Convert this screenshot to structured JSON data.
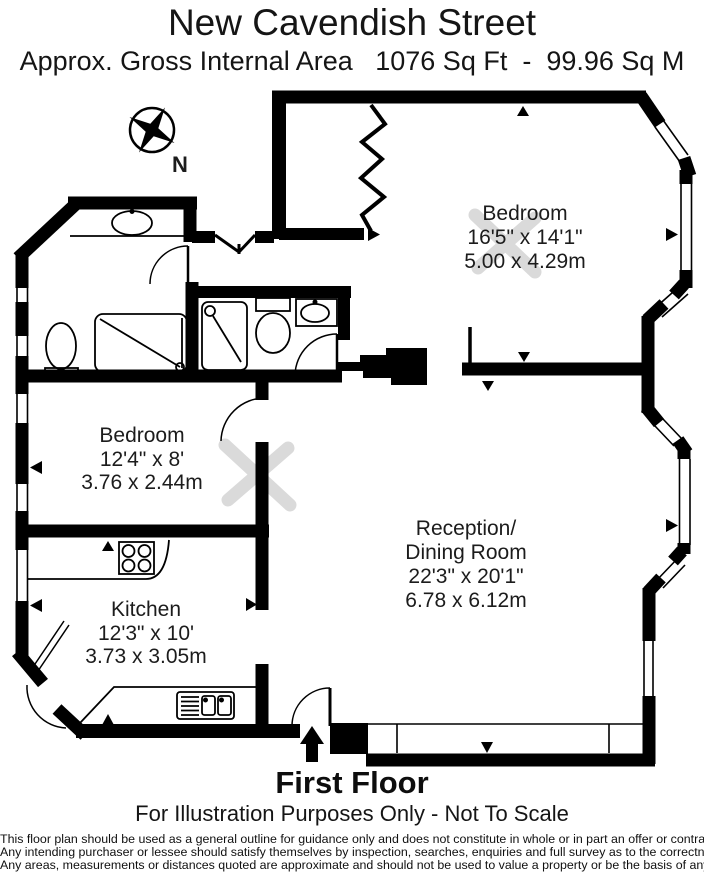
{
  "header": {
    "title": "New Cavendish Street",
    "area_line": "Approx. Gross Internal Area   1076 Sq Ft  -  99.96 Sq M"
  },
  "compass": {
    "north_label": "N"
  },
  "rooms": {
    "bedroom_main": {
      "name": "Bedroom",
      "imperial": "16'5\" x 14'1\"",
      "metric": "5.00 x 4.29m"
    },
    "bedroom_second": {
      "name": "Bedroom",
      "imperial": "12'4\" x 8'",
      "metric": "3.76 x 2.44m"
    },
    "kitchen": {
      "name": "Kitchen",
      "imperial": "12'3\" x 10'",
      "metric": "3.73 x 3.05m"
    },
    "reception": {
      "name_line1": "Reception/",
      "name_line2": "Dining Room",
      "imperial": "22'3\" x 20'1\"",
      "metric": "6.78 x 6.12m"
    }
  },
  "footer": {
    "floor_label": "First Floor",
    "scale_note": "For Illustration Purposes Only - Not To Scale",
    "disclaimer": [
      "This floor plan should be used as a general outline for guidance only and does not constitute in whole or in part an offer or contract.",
      "Any intending purchaser or lessee should satisfy themselves by inspection, searches, enquiries and full survey as to the correctness of each statement.",
      "Any areas, measurements or distances quoted are approximate and should not be used to value a property or be the basis of any sale or let."
    ]
  },
  "colors": {
    "wall": "#000000",
    "text": "#1c1c1c",
    "watermark": "#dadada"
  }
}
